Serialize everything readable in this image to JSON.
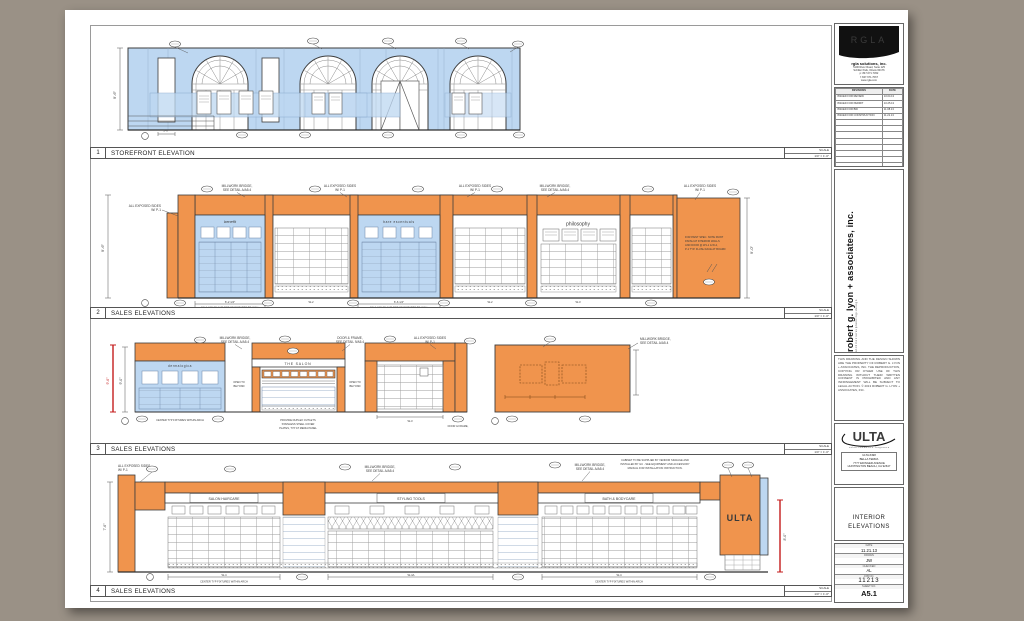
{
  "views": [
    {
      "num": "1",
      "title": "STOREFRONT ELEVATION",
      "scale_label": "SCALE",
      "scale_value": "1/4\" = 1'-0\""
    },
    {
      "num": "2",
      "title": "SALES ELEVATIONS",
      "scale_label": "SCALE",
      "scale_value": "1/4\" = 1'-0\""
    },
    {
      "num": "3",
      "title": "SALES ELEVATIONS",
      "scale_label": "SCALE",
      "scale_value": "1/4\" = 1'-0\""
    },
    {
      "num": "4",
      "title": "SALES ELEVATIONS",
      "scale_label": "SCALE",
      "scale_value": "1/4\" = 1'-0\""
    }
  ],
  "signs": {
    "benefit": "benefit",
    "bare": "bare escentuals",
    "philosophy": "philosophy",
    "dermalogica": "dermalogica",
    "salon": "THE SALON",
    "haircare": "SALON HAIRCARE",
    "styling": "STYLING TOOLS",
    "bodycare": "BATH & BODYCARE",
    "ulta": "ULTA"
  },
  "notes": {
    "millwork1": "MILLWORK BRIDGE,",
    "millwork2": "SEE DETAIL A/A5.4",
    "exposed1": "ALL EXPOSED SIDES",
    "exposed2": "W/ P-1",
    "caulk": "CAULK BACK AND TOP OF FIXTURES TO WALL",
    "center": "CENTER TYP FIXTURES WITHIN ARCH",
    "doorframe1": "DOOR & FRAME,",
    "doorframe2": "SEE DETAIL 9/A5.4",
    "open1": "OPEN TO",
    "open2": "BEYOND",
    "media1": "PROVIDE DUPLEX OUTLETS",
    "media2": "STAINLESS STEEL COVER",
    "media3": "PLATES, TYP AT MEDIA PANEL",
    "paint1": "FOR PAINT SPEC. NOTE PAINT",
    "paint2": "FINISH AT INTERIOR WALLS",
    "paint3": "AND DOOR @ W1-1 & W-2,",
    "paint4": "P-1 TYP. FLUSH FACE AT BOARD",
    "cabinet1": "CABINET TO BE SUPPLIED BY VENDOR SIGNAGE AND",
    "cabinet2": "INSTALLED BY GC - SEE EQUIPMENT AND ACCESSORY",
    "cabinet3": "MANUAL FOR INSTALLATION INSTRUCTION."
  },
  "dims": {
    "h96": "9'-6\"",
    "h90": "9'-0\"",
    "h76": "7'-6\"",
    "h80": "8'-0\"",
    "w6214": "6'-2 1/4\"",
    "w6614": "6'-6 1/4\"",
    "w2": "W-2",
    "w3": "W-3",
    "w4": "W-4",
    "w4a": "W-4A",
    "w10": "1'-0\""
  },
  "titleblock": {
    "rgla": {
      "logo": "RGLA",
      "firm": "rgla solutions, inc.",
      "addr1": "5100 River Road, Suite 125",
      "addr2": "Schiller Park, Illinois 60176",
      "addr3": "p: 847.671.7452",
      "addr4": "f: 847.671.7067",
      "addr5": "www.rgla.com"
    },
    "revisions": {
      "header_label": "REVISIONS",
      "header_date": "DATE",
      "rows": [
        {
          "label": "ISSUED FOR REVIEW",
          "date": "10.04.13"
        },
        {
          "label": "ISSUED FOR PERMIT",
          "date": "10.25.13"
        },
        {
          "label": "ISSUED FOR BID",
          "date": "11.08.13"
        },
        {
          "label": "ISSUED FOR CONSTRUCTION",
          "date": "11.21.13"
        }
      ]
    },
    "firm_name": "robert g. lyon + associates, inc.",
    "firm_tag": "a r c h i t e c t u r e   •   p l a n n i n g   •   d e s i g n",
    "disclaimer": "THIS DRAWING AND THE DESIGN SHOWN ARE THE PROPERTY OF ROBERT G. LYON + ASSOCIATES, INC. THE REPRODUCTION, COPYING OR OTHER USE OF THIS DRAWING WITHOUT THEIR WRITTEN CONSENT IS PROHIBITED AND ANY INFRINGEMENT WILL BE SUBJECT TO LEGAL ACTION. © 2013 ROBERT G. LYON + ASSOCIATES, INC.",
    "ulta": {
      "wordmark": "ULTA",
      "tagline": "s a l o n  ·  c o s m e t i c s  ·  f r a g r a n c e",
      "store1": "ULTA #498",
      "store2": "BELLA TERRA",
      "store3": "7777 EDINGER AVENUE",
      "store4": "HUNTINGTON BEACH, CA 92647"
    },
    "sheet_title1": "INTERIOR",
    "sheet_title2": "ELEVATIONS",
    "info": {
      "date_label": "DATE",
      "date": "11.21.13",
      "drawn_label": "DRAWN",
      "drawn": "JW",
      "checked_label": "CHECKED",
      "checked": "AL",
      "job_label": "JOB NO.",
      "job": "11213",
      "sheet_label": "SHEET NO.",
      "sheet": "A5.1"
    }
  }
}
